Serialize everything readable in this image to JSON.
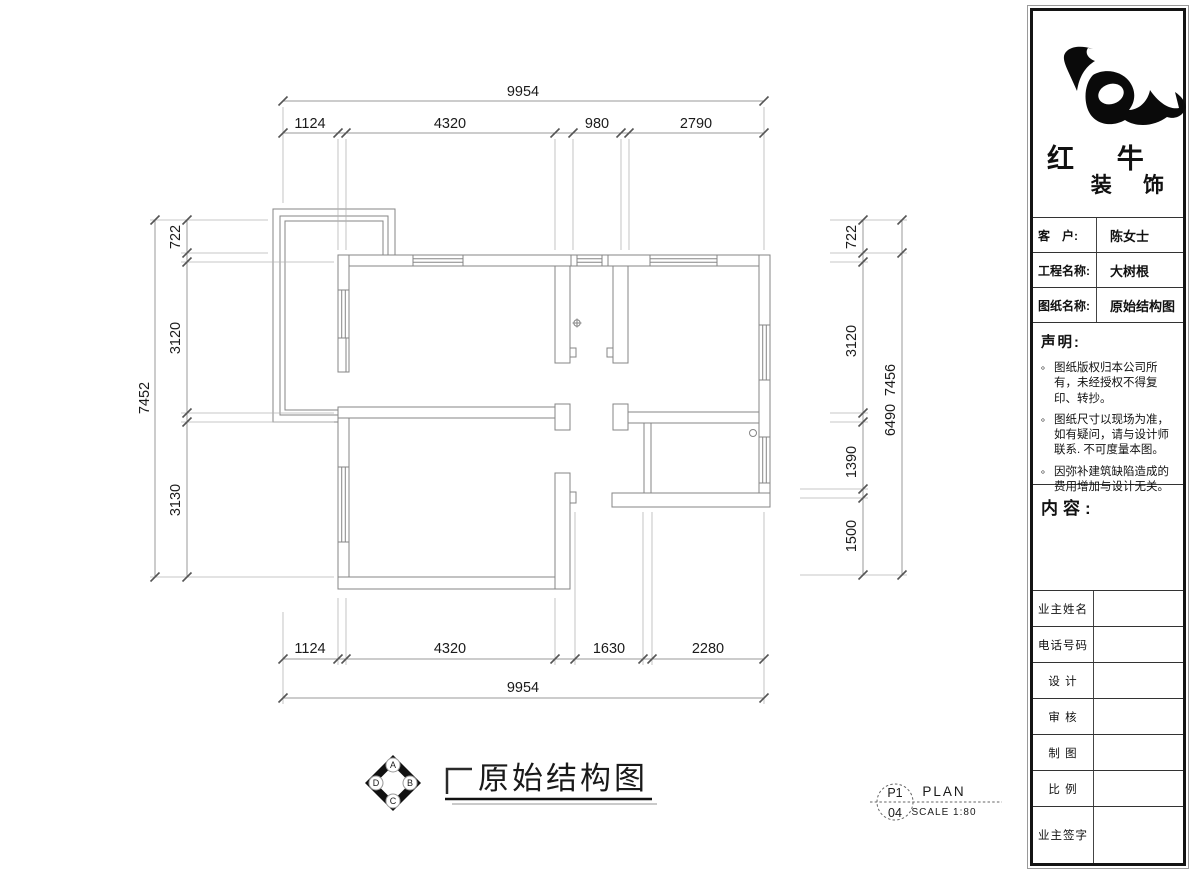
{
  "drawing": {
    "title": "原始结构图",
    "compass": {
      "n": "A",
      "e": "B",
      "s": "C",
      "w": "D"
    },
    "stamp": {
      "page": "P1",
      "sheet": "04",
      "plan": "PLAN",
      "scale": "SCALE 1:80"
    },
    "dims": {
      "top": {
        "overall": "9954",
        "chain": [
          "1124",
          "4320",
          "980",
          "2790"
        ]
      },
      "bottom": {
        "overall": "9954",
        "chain": [
          "1124",
          "4320",
          "1630",
          "2280"
        ]
      },
      "left": {
        "overall": "7452",
        "chain": [
          "722",
          "3120",
          "3130"
        ]
      },
      "right": {
        "outer": [
          "7456",
          "6490"
        ],
        "chain": [
          "722",
          "3120",
          "1390",
          "1500"
        ]
      }
    }
  },
  "titleblock": {
    "brand": {
      "line1": "红 牛",
      "line2": "装 饰"
    },
    "rows": [
      {
        "label": "客　户:",
        "value": "陈女士"
      },
      {
        "label": "工程名称:",
        "value": "大树根"
      },
      {
        "label": "图纸名称:",
        "value": "原始结构图"
      }
    ],
    "statement": {
      "heading": "声明:",
      "bullet": "。",
      "items": [
        "图纸版权归本公司所有，未经授权不得复印、转抄。",
        "图纸尺寸以现场为准，如有疑问，请与设计师联系. 不可度量本图。",
        "因弥补建筑缺陷造成的费用增加与设计无关。"
      ]
    },
    "content_label": "内容:",
    "sign_rows": [
      {
        "label": "业主姓名"
      },
      {
        "label": "电话号码"
      },
      {
        "label": "设 计"
      },
      {
        "label": "审 核"
      },
      {
        "label": "制 图"
      },
      {
        "label": "比 例"
      },
      {
        "label": "业主签字"
      }
    ]
  },
  "colors": {
    "wall_line": "#858585",
    "dim_line": "#9a9a9a",
    "ext_line": "#b5b5b5",
    "tick": "#555555",
    "text": "#1a1a1a",
    "panel_border": "#141414"
  }
}
